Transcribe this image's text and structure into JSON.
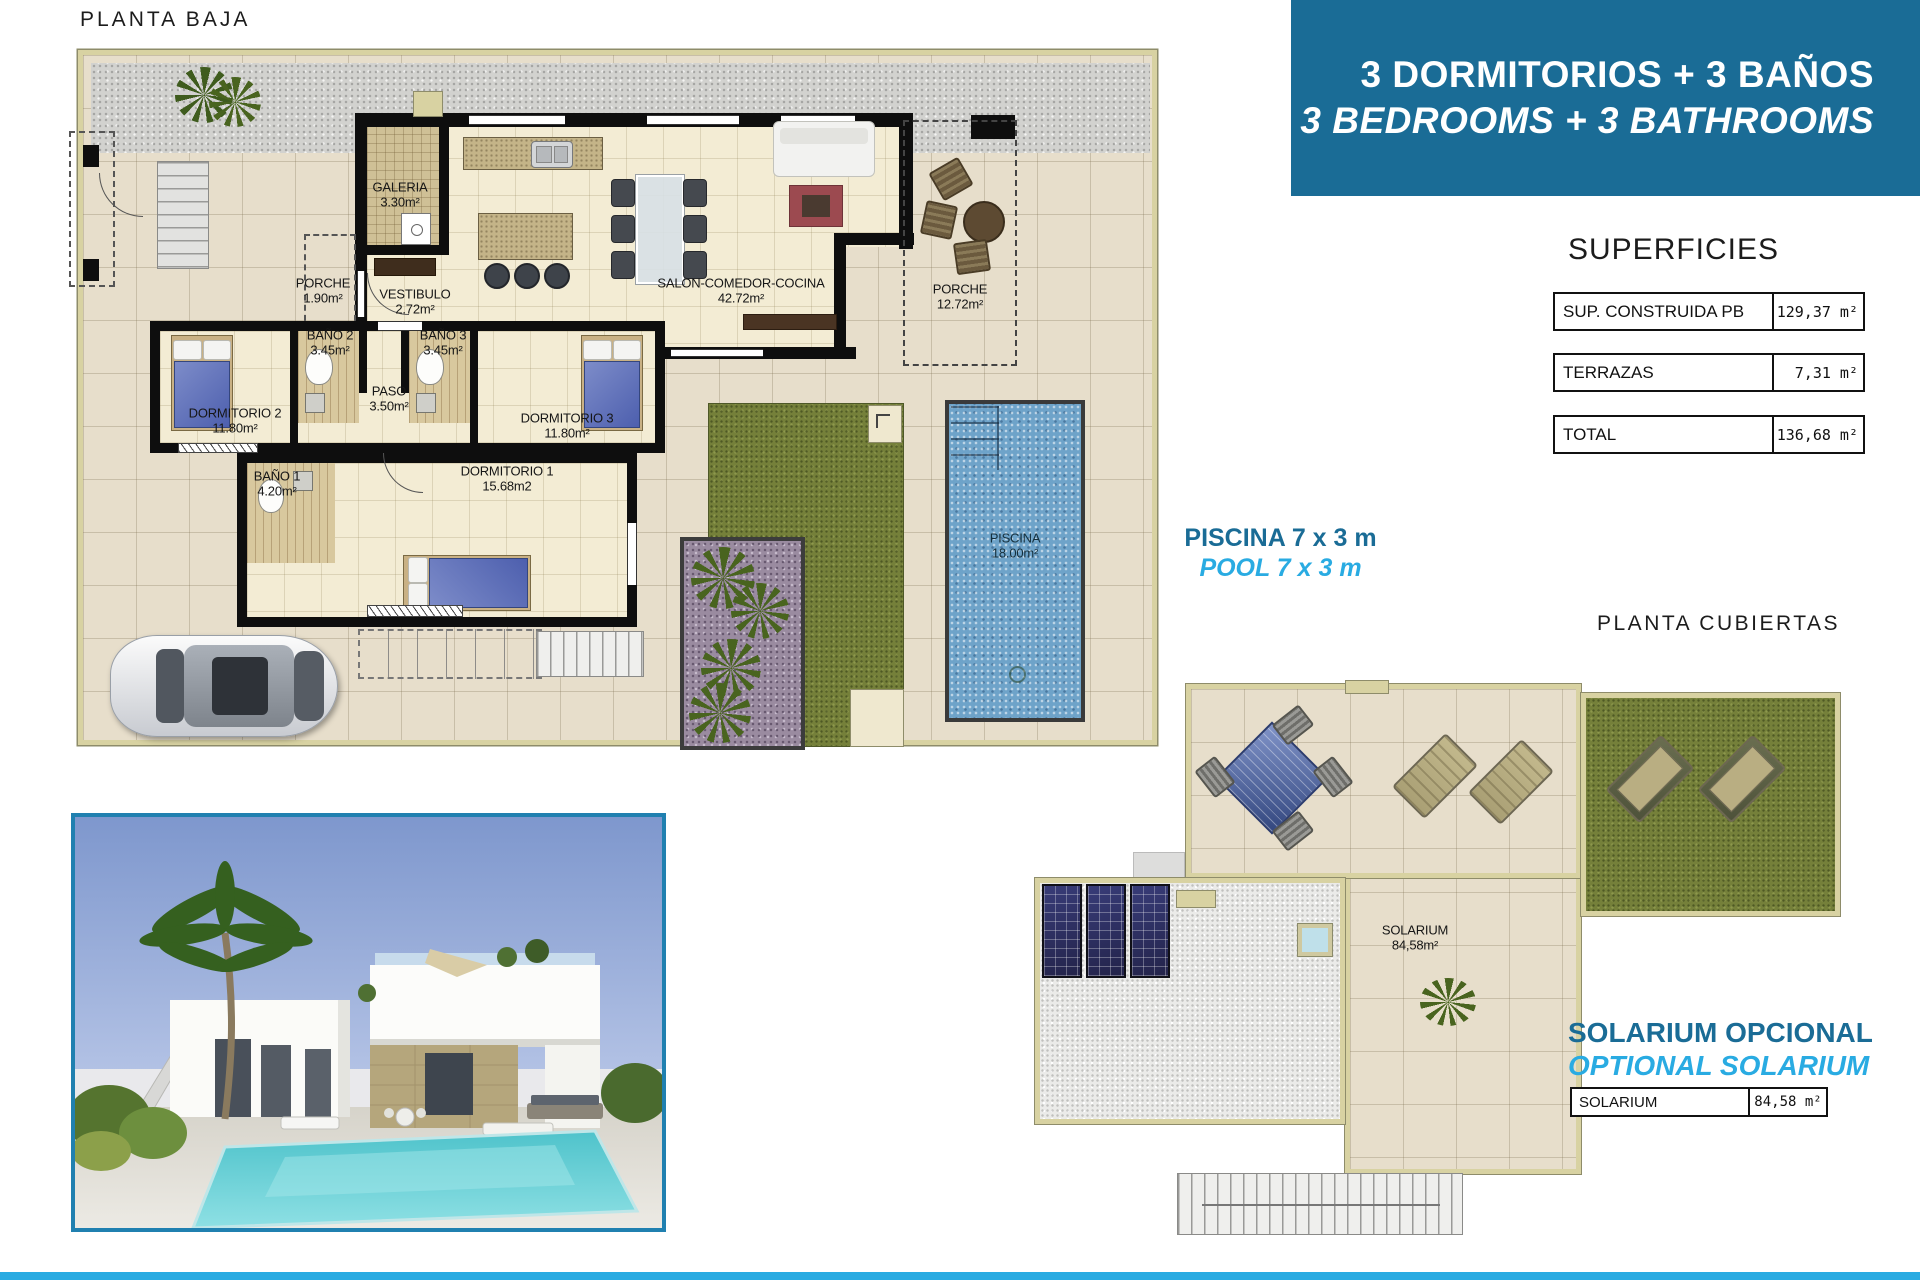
{
  "titles": {
    "ground": "PLANTA BAJA",
    "roof": "PLANTA CUBIERTAS"
  },
  "header": {
    "line1": "3 DORMITORIOS + 3 BAÑOS",
    "line2": "3 BEDROOMS + 3 BATHROOMS",
    "bg": "#1a6c96"
  },
  "superficies": {
    "title": "SUPERFICIES",
    "rows": [
      {
        "label": "SUP. CONSTRUIDA PB",
        "value": "129,37 m²"
      },
      {
        "label": "TERRAZAS",
        "value": "7,31 m²"
      },
      {
        "label": "TOTAL",
        "value": "136,68 m²"
      }
    ]
  },
  "pool_note": {
    "es": "PISCINA 7 x 3 m",
    "en": "POOL 7 x 3 m"
  },
  "solarium_note": {
    "es": "SOLARIUM OPCIONAL",
    "en": "OPTIONAL SOLARIUM"
  },
  "solarium_table": {
    "label": "SOLARIUM",
    "value": "84,58 m²"
  },
  "rooms": {
    "galeria": {
      "name": "GALERIA",
      "area": "3.30m²"
    },
    "porche1": {
      "name": "PORCHE",
      "area": "1.90m²"
    },
    "vestibulo": {
      "name": "VESTIBULO",
      "area": "2.72m²"
    },
    "salon": {
      "name": "SALON-COMEDOR-COCINA",
      "area": "42.72m²"
    },
    "porche2": {
      "name": "PORCHE",
      "area": "12.72m²"
    },
    "bano2": {
      "name": "BAÑO 2",
      "area": "3.45m²"
    },
    "bano3": {
      "name": "BAÑO 3",
      "area": "3.45m²"
    },
    "paso": {
      "name": "PASO",
      "area": "3.50m²"
    },
    "dorm2": {
      "name": "DORMITORIO 2",
      "area": "11.80m²"
    },
    "dorm3": {
      "name": "DORMITORIO 3",
      "area": "11.80m²"
    },
    "bano1": {
      "name": "BAÑO 1",
      "area": "4.20m²"
    },
    "dorm1": {
      "name": "DORMITORIO 1",
      "area": "15.68m2"
    },
    "piscina": {
      "name": "PISCINA",
      "area": "18.00m²"
    }
  },
  "roof_rooms": {
    "solarium": {
      "name": "SOLARIUM",
      "area": "84,58m²"
    }
  },
  "colors": {
    "accent_dark": "#1a6c96",
    "accent_light": "#29abe2",
    "bottom_bar": "#29abe2"
  }
}
